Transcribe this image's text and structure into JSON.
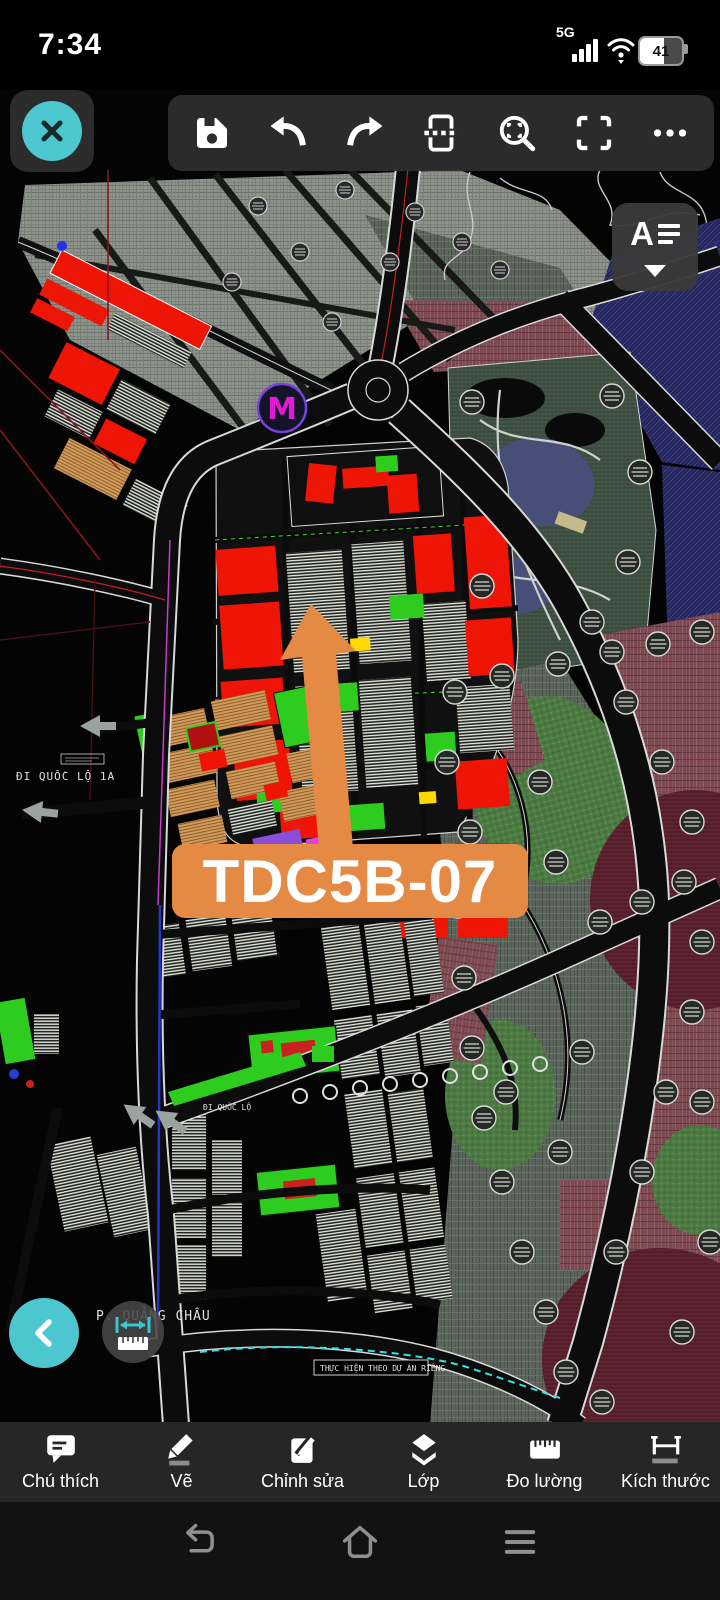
{
  "status_bar": {
    "time": "7:34",
    "network": "5G",
    "battery": "41"
  },
  "top_toolbar": {
    "close_icon": "close-x",
    "icons": [
      "save-floppy",
      "undo-arrow",
      "redo-arrow",
      "viewport-section",
      "zoom-window",
      "fit-fullscreen",
      "more-ellipsis"
    ]
  },
  "style_button": {
    "letter": "A",
    "icon": "annotation-style-dropdown"
  },
  "annotation": {
    "label": "TDC5B-07",
    "color": "#e58a45"
  },
  "map": {
    "labels": {
      "road_national": "ĐI QUỐC LỘ 1A",
      "road_national_short": "ĐI QUỐC LỘ",
      "ward": "P. QUẢNG CHÂU",
      "note": "THỰC HIỆN THEO DỰ ÁN RIÊNG",
      "logo_letter": "M"
    },
    "colors": {
      "parcel_red": "#ee1506",
      "park_green": "#2ecc1e",
      "water_navy": "#232457",
      "accent_teal": "#4cc7cf",
      "annotation_orange": "#e58a45"
    }
  },
  "floating_buttons": {
    "back_icon": "chevron-left",
    "measure_icon": "ruler-measure"
  },
  "bottom_toolbar": {
    "items": [
      {
        "label": "Chú thích",
        "icon": "comment-annotation"
      },
      {
        "label": "Vẽ",
        "icon": "pencil-draw"
      },
      {
        "label": "Chỉnh sửa",
        "icon": "edit-note"
      },
      {
        "label": "Lớp",
        "icon": "layers-stack"
      },
      {
        "label": "Đo lường",
        "icon": "ruler"
      },
      {
        "label": "Kích thước",
        "icon": "dimension-lines"
      }
    ]
  },
  "nav_bar": {
    "icons": [
      "back-return",
      "home-house",
      "menu-lines"
    ]
  }
}
